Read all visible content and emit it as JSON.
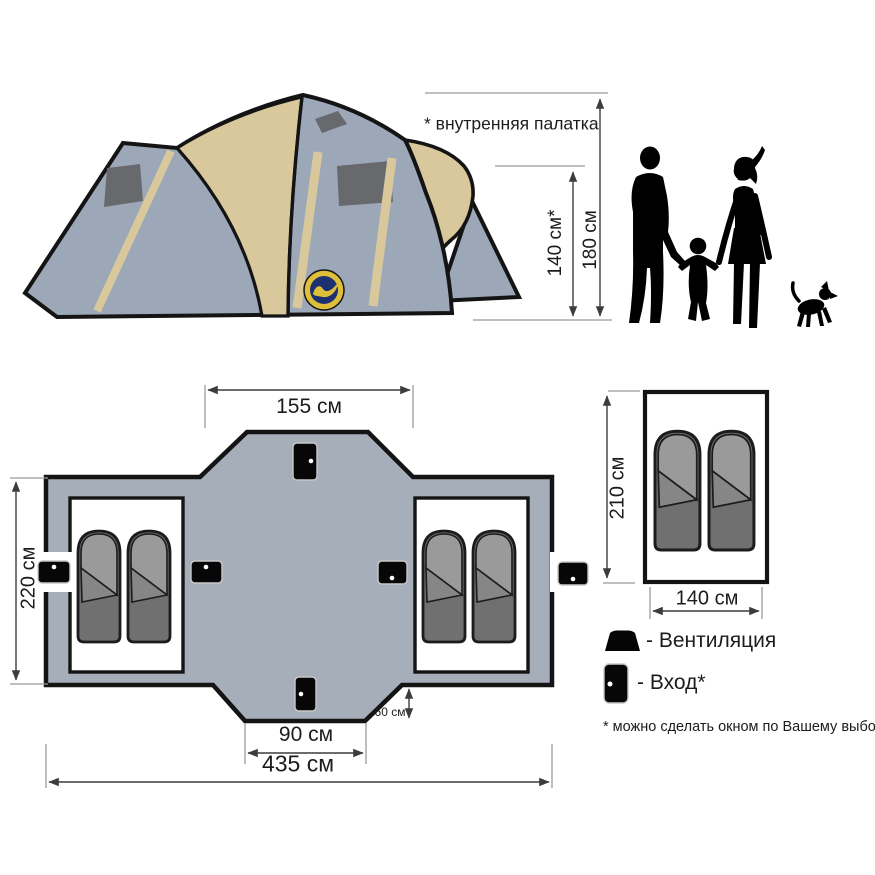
{
  "tent_view": {
    "inner_tent_note": "* внутренняя палатка",
    "height_inner": "140 см*",
    "height_outer": "180 см"
  },
  "floor_plan": {
    "width_top": "155 см",
    "depth_side": "220 см",
    "entrance_width": "90 см",
    "width_total": "435 см",
    "vestibule_depth": "60 см"
  },
  "inner_room": {
    "height": "210 см",
    "width": "140 см"
  },
  "legend": {
    "ventilation": "- Вентиляция",
    "entrance": "- Вход*",
    "footnote": "* можно сделать окном по Вашему выбору"
  },
  "colors": {
    "tent_fabric": "#9CA7B7",
    "tent_awning": "#D8C89B",
    "tent_window": "#67696C",
    "plan_fill": "#A6AEB9",
    "badge_navy": "#1D3171",
    "badge_gold": "#DFBE3A"
  }
}
